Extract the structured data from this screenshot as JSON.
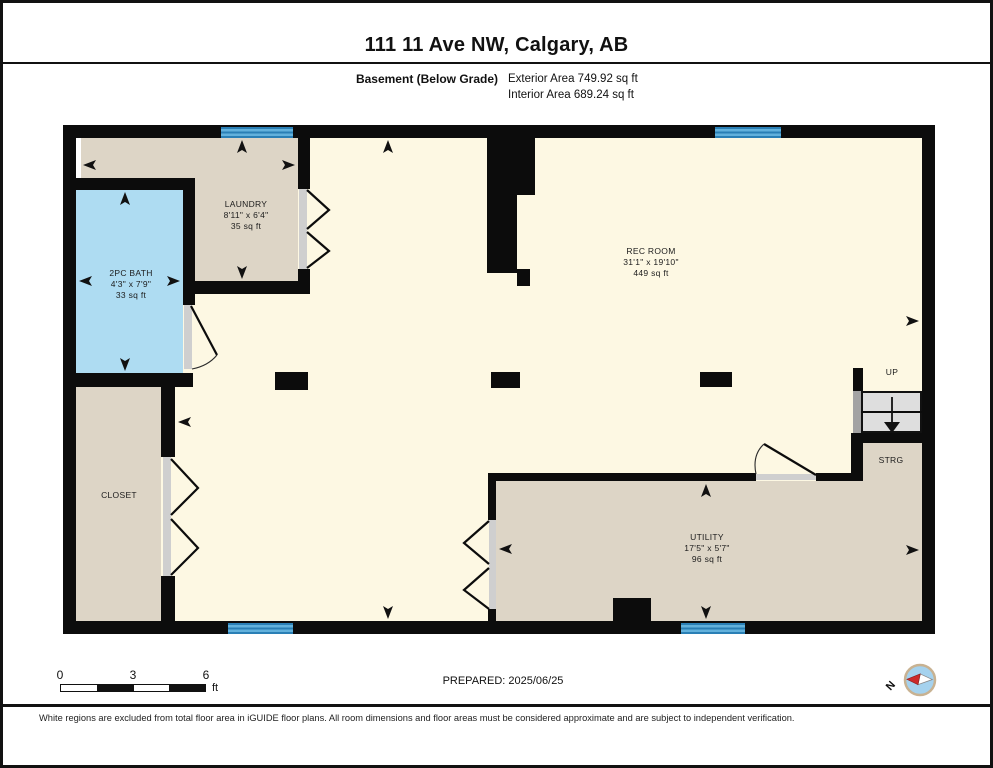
{
  "header": {
    "title": "111 11 Ave NW, Calgary, AB",
    "floor_label": "Basement (Below Grade)",
    "exterior_area": "Exterior Area 749.92 sq ft",
    "interior_area": "Interior Area 689.24 sq ft"
  },
  "rooms": {
    "laundry": {
      "name": "LAUNDRY",
      "dims": "8'11\" x 6'4\"",
      "area": "35 sq ft"
    },
    "bath": {
      "name": "2PC BATH",
      "dims": "4'3\" x 7'9\"",
      "area": "33 sq ft"
    },
    "rec": {
      "name": "REC ROOM",
      "dims": "31'1\" x 19'10\"",
      "area": "449 sq ft"
    },
    "closet": {
      "name": "CLOSET"
    },
    "utility": {
      "name": "UTILITY",
      "dims": "17'5\" x 5'7\"",
      "area": "96 sq ft"
    },
    "strg": {
      "name": "STRG"
    },
    "stairs": {
      "name": "UP"
    }
  },
  "scale_bar": {
    "tick_0": "0",
    "tick_3": "3",
    "tick_6": "6",
    "unit": "ft"
  },
  "compass": {
    "north_label": "N"
  },
  "footer": {
    "prepared": "PREPARED: 2025/06/25",
    "disclaimer": "White regions are excluded from total floor area in iGUIDE floor plans. All room dimensions and floor areas must be considered approximate and are subject to independent verification."
  },
  "colors": {
    "wall_black": "#0c0c0c",
    "room_beige": "#ddd5c6",
    "room_yellow": "#fdf8e3",
    "bath_blue": "#aedcf2",
    "window_blue": "#4aa5d4",
    "stair_gray": "#dedede",
    "threshold_gray": "#cfcfcf",
    "compass_red": "#cc2a2a",
    "compass_blue": "#a5d2ee"
  }
}
